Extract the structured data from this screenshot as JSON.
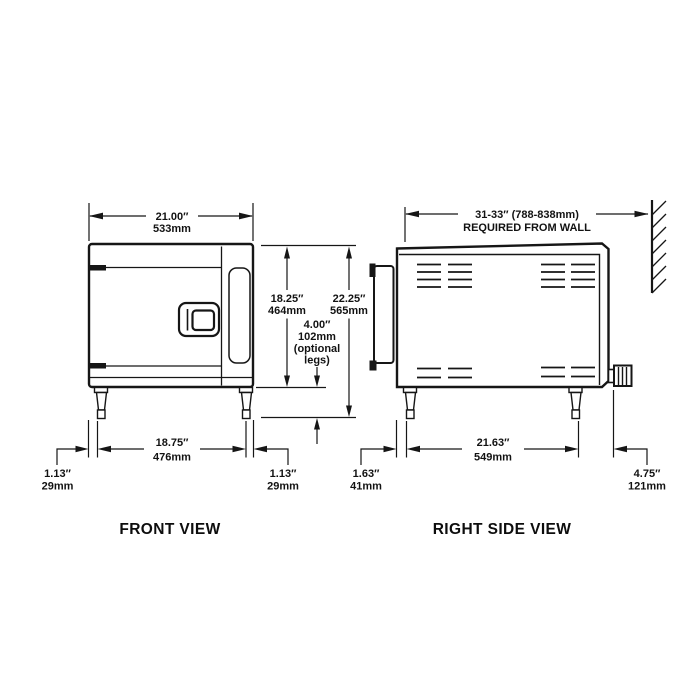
{
  "front_view": {
    "title": "FRONT VIEW",
    "width": {
      "in": "21.00″",
      "mm": "533mm"
    },
    "leg_span": {
      "in": "18.75″",
      "mm": "476mm"
    },
    "left_inset": {
      "in": "1.13″",
      "mm": "29mm"
    },
    "right_inset": {
      "in": "1.13″",
      "mm": "29mm"
    }
  },
  "heights": {
    "body": {
      "in": "18.25″",
      "mm": "464mm"
    },
    "total": {
      "in": "22.25″",
      "mm": "565mm"
    },
    "legs": {
      "in": "4.00″",
      "mm": "102mm",
      "note_line1": "(optional",
      "note_line2": "legs)"
    }
  },
  "side_view": {
    "title": "RIGHT SIDE VIEW",
    "wall_clearance": {
      "line1": "31-33″ (788-838mm)",
      "line2": "REQUIRED FROM WALL"
    },
    "leg_span": {
      "in": "21.63″",
      "mm": "549mm"
    },
    "front_inset": {
      "in": "1.63″",
      "mm": "41mm"
    },
    "rear_extent": {
      "in": "4.75″",
      "mm": "121mm"
    }
  },
  "colors": {
    "line": "#161616",
    "background": "#ffffff"
  }
}
